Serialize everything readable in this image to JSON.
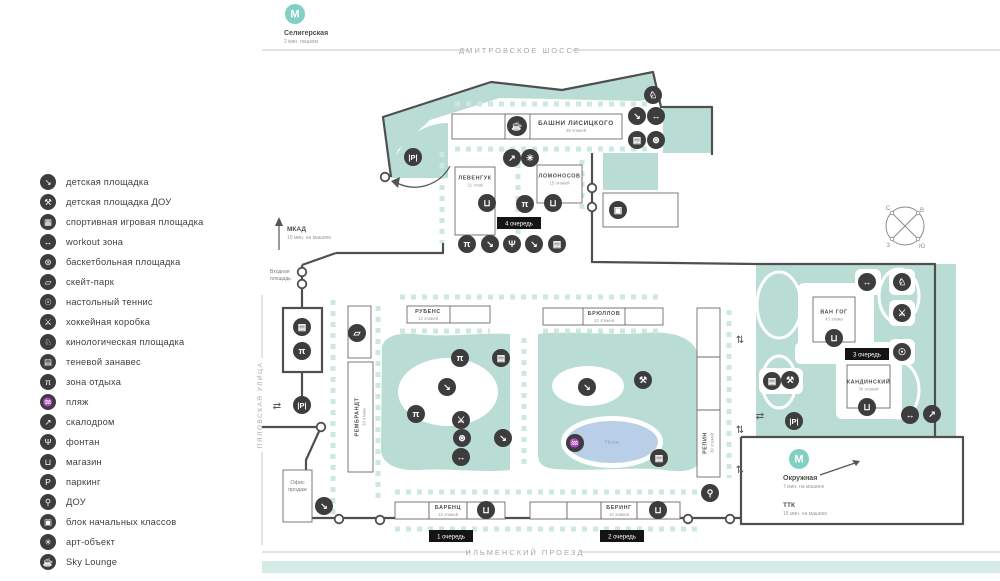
{
  "colors": {
    "teal": "#b9ddd4",
    "teal_light": "#cde8e1",
    "band": "#d5ece6",
    "pond": "#b9cfe8",
    "icon_bg": "#3d3d3d",
    "road": "#4f4f4f",
    "badge_bg": "#141414",
    "metro": "#82cfc3",
    "street_text": "#a3aaa8",
    "text_dark": "#4d4d4d",
    "text_gray": "#9a9a9a",
    "pond_text": "#93a9c6"
  },
  "legend": {
    "items": [
      {
        "icon": "playground",
        "label": "детская площадка"
      },
      {
        "icon": "playground-dou",
        "label": "детская площадка ДОУ"
      },
      {
        "icon": "sports-court",
        "label": "спортивная игровая площадка"
      },
      {
        "icon": "workout",
        "label": "workout зона"
      },
      {
        "icon": "basketball",
        "label": "баскетбольная площадка"
      },
      {
        "icon": "skate-park",
        "label": "скейт-парк"
      },
      {
        "icon": "table-tennis",
        "label": "настольный теннис"
      },
      {
        "icon": "hockey-rink",
        "label": "хоккейная коробка"
      },
      {
        "icon": "dog-park",
        "label": "кинологическая площадка"
      },
      {
        "icon": "shade-canopy",
        "label": "теневой занавес"
      },
      {
        "icon": "rest-area",
        "label": "зона отдыха"
      },
      {
        "icon": "beach",
        "label": "пляж"
      },
      {
        "icon": "climbing-wall",
        "label": "скалодром"
      },
      {
        "icon": "fountain",
        "label": "фонтан"
      },
      {
        "icon": "store",
        "label": "магазин"
      },
      {
        "icon": "parking",
        "label": "паркинг"
      },
      {
        "icon": "kindergarten",
        "label": "ДОУ"
      },
      {
        "icon": "primary-school",
        "label": "блок начальных классов"
      },
      {
        "icon": "art-object",
        "label": "арт-объект"
      },
      {
        "icon": "sky-lounge",
        "label": "Sky Lounge"
      }
    ]
  },
  "icon_glyphs": {
    "playground": "↘",
    "playground-dou": "⚒",
    "sports-court": "▦",
    "workout": "↔",
    "basketball": "⊛",
    "skate-park": "▱",
    "table-tennis": "☉",
    "hockey-rink": "⚔",
    "dog-park": "♘",
    "shade-canopy": "▤",
    "rest-area": "π",
    "beach": "♒",
    "climbing-wall": "↗",
    "fountain": "Ψ",
    "store": "⊔",
    "parking": "P",
    "kindergarten": "⚲",
    "primary-school": "▣",
    "art-object": "✳",
    "sky-lounge": "☕"
  },
  "streets": {
    "top": "ДМИТРОВСКОЕ ШОССЕ",
    "bottom": "ИЛЬМЕНСКИЙ ПРОЕЗД",
    "left": "ПЯЛОВСКАЯ УЛИЦА"
  },
  "transit": {
    "seligerskaya": {
      "symbol": "М",
      "name": "Селигерская",
      "note": "2 мин. пешком"
    },
    "okruzhnaya": {
      "symbol": "М",
      "name": "Окружная",
      "note": "7 мин. на машине"
    },
    "mkad": {
      "name": "МКАД",
      "note": "10 мин. на машине"
    },
    "ttk": {
      "name": "ТТК",
      "note": "15 мин. на машине"
    }
  },
  "map": {
    "entrance_label": [
      "Входная",
      "площадь"
    ],
    "sales_office_label": [
      "Офис",
      "продаж"
    ],
    "pond_label": "Пляж",
    "compass": {
      "n": "С",
      "e": "В",
      "w": "З",
      "s": "Ю"
    },
    "queues": [
      {
        "label": "1 очередь",
        "x": 451,
        "y": 536
      },
      {
        "label": "2 очередь",
        "x": 622,
        "y": 536
      },
      {
        "label": "3 очередь",
        "x": 867,
        "y": 354
      },
      {
        "label": "4 очередь",
        "x": 519,
        "y": 223
      }
    ],
    "buildings": [
      {
        "key": "lisitsky",
        "name": "БАШНИ ЛИСИЦКОГО",
        "floors": "39 этажей",
        "x": 452,
        "y": 114,
        "w": 170,
        "h": 25,
        "label_cx": 576,
        "dividers": [
          505,
          530
        ],
        "big": true
      },
      {
        "key": "levenguk",
        "name": "ЛЕВЕНГУК",
        "floors": "21 этаж",
        "x": 455,
        "y": 167,
        "w": 40,
        "h": 68,
        "label_cy": 181
      },
      {
        "key": "lomonosov",
        "name": "ЛОМОНОСОВ",
        "floors": "15 этажей",
        "x": 537,
        "y": 165,
        "w": 45,
        "h": 38,
        "label_cy": 179
      },
      {
        "key": "rubens",
        "name": "РУБЕНС",
        "floors": "13 этажей",
        "x": 407,
        "y": 306,
        "w": 83,
        "h": 17,
        "label_cx": 428,
        "dividers": [
          450
        ]
      },
      {
        "key": "bryullov",
        "name": "БРЮЛЛОВ",
        "floors": "13 этажей",
        "x": 543,
        "y": 308,
        "w": 120,
        "h": 17,
        "label_cx": 604,
        "dividers": [
          583,
          625
        ]
      },
      {
        "key": "vangogh",
        "name": "ВАН ГОГ",
        "floors": "43 этажа",
        "x": 813,
        "y": 297,
        "w": 42,
        "h": 45,
        "label_cy": 315
      },
      {
        "key": "kandinsky",
        "name": "КАНДИНСКИЙ",
        "floors": "36 этажей",
        "x": 847,
        "y": 365,
        "w": 43,
        "h": 43,
        "label_cy": 385
      },
      {
        "key": "rembrandt",
        "name": "РЕМБРАНДТ",
        "floors": "33 этажа",
        "x": 348,
        "y": 362,
        "w": 25,
        "h": 110,
        "vert": true
      },
      {
        "key": "rembrandt-strip",
        "x": 348,
        "y": 306,
        "w": 23,
        "h": 52
      },
      {
        "key": "repin",
        "name": "РЕПИН",
        "floors": "39 этажей",
        "x": 697,
        "y": 308,
        "w": 23,
        "h": 169,
        "vert": true,
        "label_cy": 443,
        "hdividers": [
          357,
          410
        ]
      },
      {
        "key": "barenz-wing",
        "x": 395,
        "y": 502,
        "w": 34,
        "h": 17
      },
      {
        "key": "barenz",
        "name": "БАРЕНЦ",
        "floors": "13 этажей",
        "x": 429,
        "y": 502,
        "w": 38,
        "h": 17
      },
      {
        "key": "barenz-shop",
        "x": 467,
        "y": 502,
        "w": 38,
        "h": 17
      },
      {
        "key": "bering-wing1",
        "x": 530,
        "y": 502,
        "w": 37,
        "h": 17
      },
      {
        "key": "bering-wing2",
        "x": 567,
        "y": 502,
        "w": 34,
        "h": 17
      },
      {
        "key": "bering",
        "name": "БЕРИНГ",
        "floors": "14 этажей",
        "x": 601,
        "y": 502,
        "w": 36,
        "h": 17
      },
      {
        "key": "bering-shop",
        "x": 637,
        "y": 502,
        "w": 43,
        "h": 17
      },
      {
        "key": "school-block",
        "x": 603,
        "y": 193,
        "w": 75,
        "h": 34
      },
      {
        "key": "sales-office",
        "x": 283,
        "y": 470,
        "w": 29,
        "h": 52,
        "office": true
      },
      {
        "key": "canopy-box",
        "x": 283,
        "y": 308,
        "w": 39,
        "h": 64,
        "thick": true
      }
    ],
    "icons": [
      [
        "dog-park",
        653,
        95
      ],
      [
        "playground",
        637,
        116
      ],
      [
        "workout",
        656,
        116
      ],
      [
        "shade-canopy",
        637,
        140
      ],
      [
        "basketball",
        656,
        140
      ],
      [
        "sky-lounge",
        517,
        126
      ],
      [
        "climbing-wall",
        512,
        158
      ],
      [
        "art-object",
        530,
        158
      ],
      [
        "parking",
        413,
        157
      ],
      [
        "store",
        487,
        203
      ],
      [
        "rest-area",
        525,
        204
      ],
      [
        "store",
        553,
        203
      ],
      [
        "primary-school",
        618,
        210
      ],
      [
        "rest-area",
        467,
        244
      ],
      [
        "playground",
        490,
        244
      ],
      [
        "fountain",
        512,
        244
      ],
      [
        "playground",
        534,
        244
      ],
      [
        "shade-canopy",
        557,
        244
      ],
      [
        "shade-canopy",
        302,
        327
      ],
      [
        "rest-area",
        302,
        351
      ],
      [
        "skate-park",
        357,
        333
      ],
      [
        "parking",
        302,
        405
      ],
      [
        "rest-area",
        460,
        358
      ],
      [
        "shade-canopy",
        501,
        358
      ],
      [
        "playground",
        447,
        387
      ],
      [
        "rest-area",
        416,
        414
      ],
      [
        "hockey-rink",
        461,
        420
      ],
      [
        "basketball",
        462,
        438
      ],
      [
        "playground",
        503,
        438
      ],
      [
        "workout",
        461,
        457
      ],
      [
        "playground",
        587,
        387
      ],
      [
        "playground-dou",
        643,
        380
      ],
      [
        "beach",
        575,
        443
      ],
      [
        "shade-canopy",
        659,
        458
      ],
      [
        "playground",
        324,
        506
      ],
      [
        "store",
        486,
        510
      ],
      [
        "store",
        658,
        510
      ],
      [
        "kindergarten",
        710,
        493
      ],
      [
        "workout",
        867,
        282
      ],
      [
        "dog-park",
        902,
        282
      ],
      [
        "hockey-rink",
        902,
        313
      ],
      [
        "table-tennis",
        902,
        352
      ],
      [
        "shade-canopy",
        772,
        381
      ],
      [
        "playground-dou",
        790,
        380
      ],
      [
        "store",
        834,
        338
      ],
      [
        "store",
        867,
        407
      ],
      [
        "parking",
        794,
        421
      ],
      [
        "workout",
        910,
        415
      ],
      [
        "climbing-wall",
        932,
        414
      ]
    ]
  }
}
